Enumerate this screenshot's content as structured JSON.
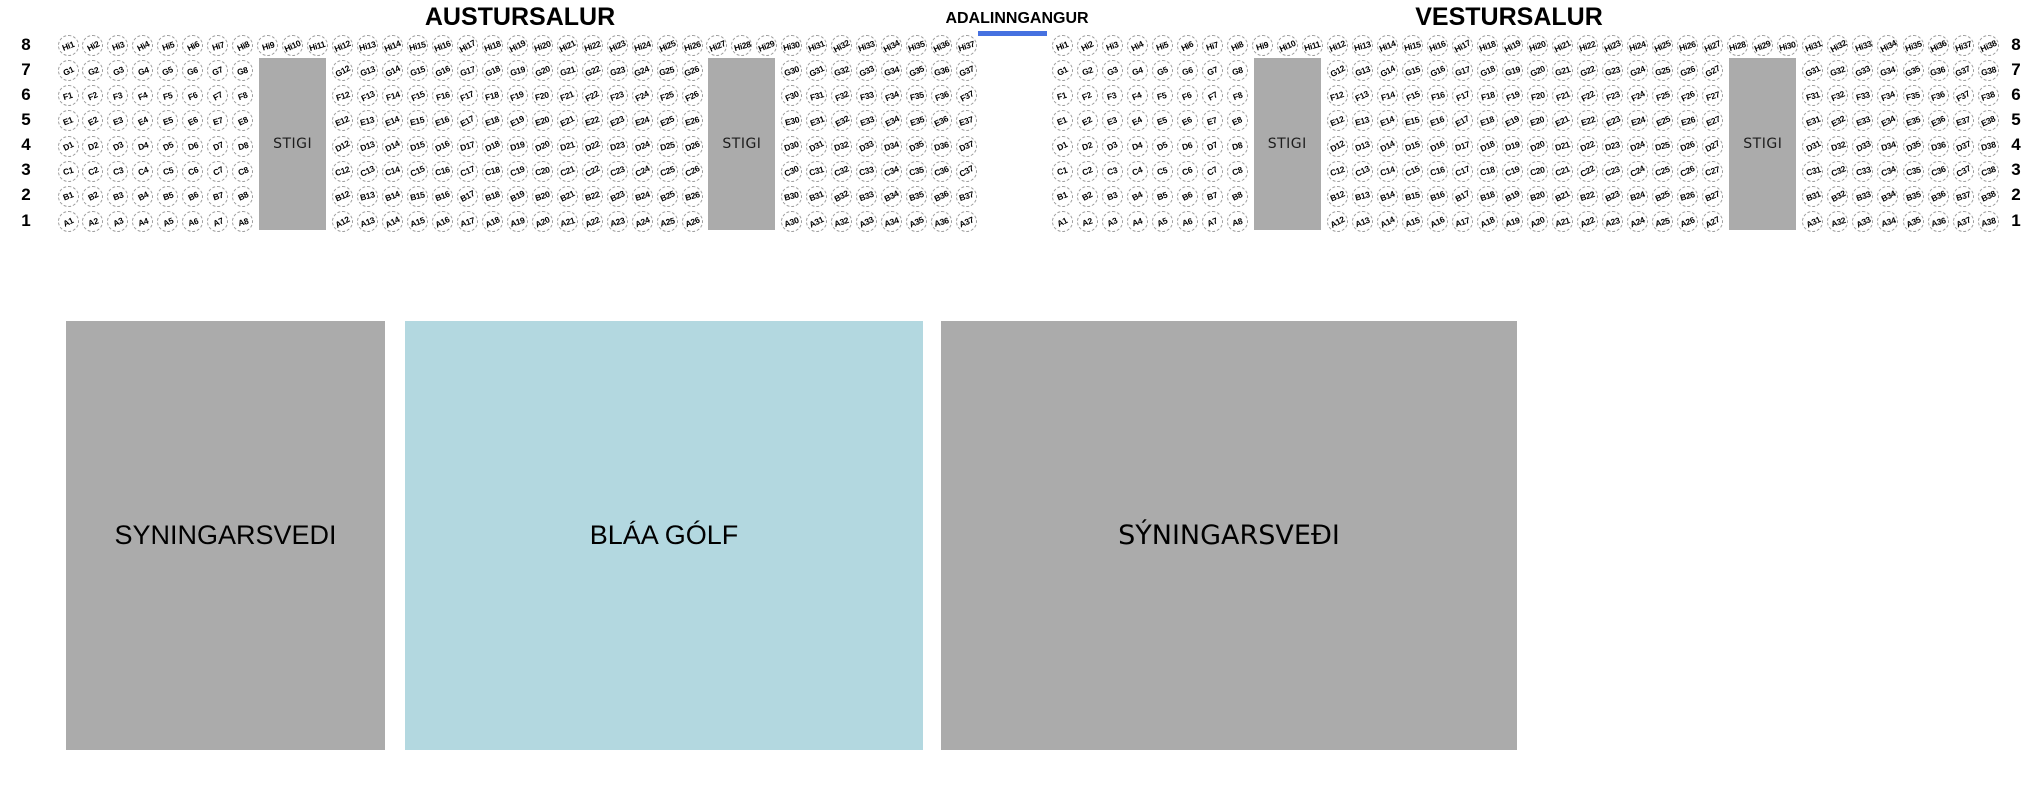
{
  "row_numbers": [
    "8",
    "7",
    "6",
    "5",
    "4",
    "3",
    "2",
    "1"
  ],
  "entrance": {
    "label": "ADALINNGANGUR",
    "underline_color": "#4671e0"
  },
  "halls": [
    {
      "id": "austursalur",
      "title": "AUSTURSALUR",
      "rows": [
        {
          "letter": "Hi",
          "row_number": "8",
          "ranges": [
            [
              1,
              37
            ]
          ]
        },
        {
          "letter": "G",
          "row_number": "7",
          "ranges": [
            [
              1,
              8
            ],
            [
              12,
              26
            ],
            [
              30,
              37
            ]
          ]
        },
        {
          "letter": "F",
          "row_number": "6",
          "ranges": [
            [
              1,
              8
            ],
            [
              12,
              26
            ],
            [
              30,
              37
            ]
          ]
        },
        {
          "letter": "E",
          "row_number": "5",
          "ranges": [
            [
              1,
              8
            ],
            [
              12,
              26
            ],
            [
              30,
              37
            ]
          ]
        },
        {
          "letter": "D",
          "row_number": "4",
          "ranges": [
            [
              1,
              8
            ],
            [
              12,
              26
            ],
            [
              30,
              37
            ]
          ]
        },
        {
          "letter": "C",
          "row_number": "3",
          "ranges": [
            [
              1,
              8
            ],
            [
              12,
              26
            ],
            [
              30,
              37
            ]
          ]
        },
        {
          "letter": "B",
          "row_number": "2",
          "ranges": [
            [
              1,
              8
            ],
            [
              12,
              26
            ],
            [
              30,
              37
            ]
          ]
        },
        {
          "letter": "A",
          "row_number": "1",
          "ranges": [
            [
              1,
              8
            ],
            [
              12,
              26
            ],
            [
              30,
              37
            ]
          ]
        }
      ],
      "stairs": [
        {
          "label": "STIGI",
          "cols": [
            9,
            11
          ]
        },
        {
          "label": "STIGI",
          "cols": [
            27,
            29
          ]
        }
      ]
    },
    {
      "id": "vestursalur",
      "title": "VESTURSALUR",
      "rows": [
        {
          "letter": "Hi",
          "row_number": "8",
          "ranges": [
            [
              1,
              38
            ]
          ]
        },
        {
          "letter": "G",
          "row_number": "7",
          "ranges": [
            [
              1,
              8
            ],
            [
              12,
              27
            ],
            [
              31,
              38
            ]
          ]
        },
        {
          "letter": "F",
          "row_number": "6",
          "ranges": [
            [
              1,
              8
            ],
            [
              12,
              27
            ],
            [
              31,
              38
            ]
          ]
        },
        {
          "letter": "E",
          "row_number": "5",
          "ranges": [
            [
              1,
              8
            ],
            [
              12,
              27
            ],
            [
              31,
              38
            ]
          ]
        },
        {
          "letter": "D",
          "row_number": "4",
          "ranges": [
            [
              1,
              8
            ],
            [
              12,
              27
            ],
            [
              31,
              38
            ]
          ]
        },
        {
          "letter": "C",
          "row_number": "3",
          "ranges": [
            [
              1,
              8
            ],
            [
              12,
              27
            ],
            [
              31,
              38
            ]
          ]
        },
        {
          "letter": "B",
          "row_number": "2",
          "ranges": [
            [
              1,
              8
            ],
            [
              12,
              27
            ],
            [
              31,
              38
            ]
          ]
        },
        {
          "letter": "A",
          "row_number": "1",
          "ranges": [
            [
              1,
              8
            ],
            [
              12,
              27
            ],
            [
              31,
              38
            ]
          ]
        }
      ],
      "stairs": [
        {
          "label": "STIGI",
          "cols": [
            9,
            11
          ]
        },
        {
          "label": "STIGI",
          "cols": [
            28,
            30
          ]
        }
      ]
    }
  ],
  "floor_areas": [
    {
      "id": "syningarsvedi-left",
      "label": "SYNINGARSVEDI",
      "color": "#ababab"
    },
    {
      "id": "blaa-golf",
      "label": "BLÁA GÓLF",
      "color": "#b3d8e0"
    },
    {
      "id": "syningarsvedi-right",
      "label": "SÝNINGARSVEÐI",
      "color": "#ababab"
    }
  ],
  "colors": {
    "background": "#ffffff",
    "stairs_fill": "#ababab",
    "seat_border": "#999999",
    "seat_text": "#000000",
    "entrance_underline": "#4671e0"
  }
}
